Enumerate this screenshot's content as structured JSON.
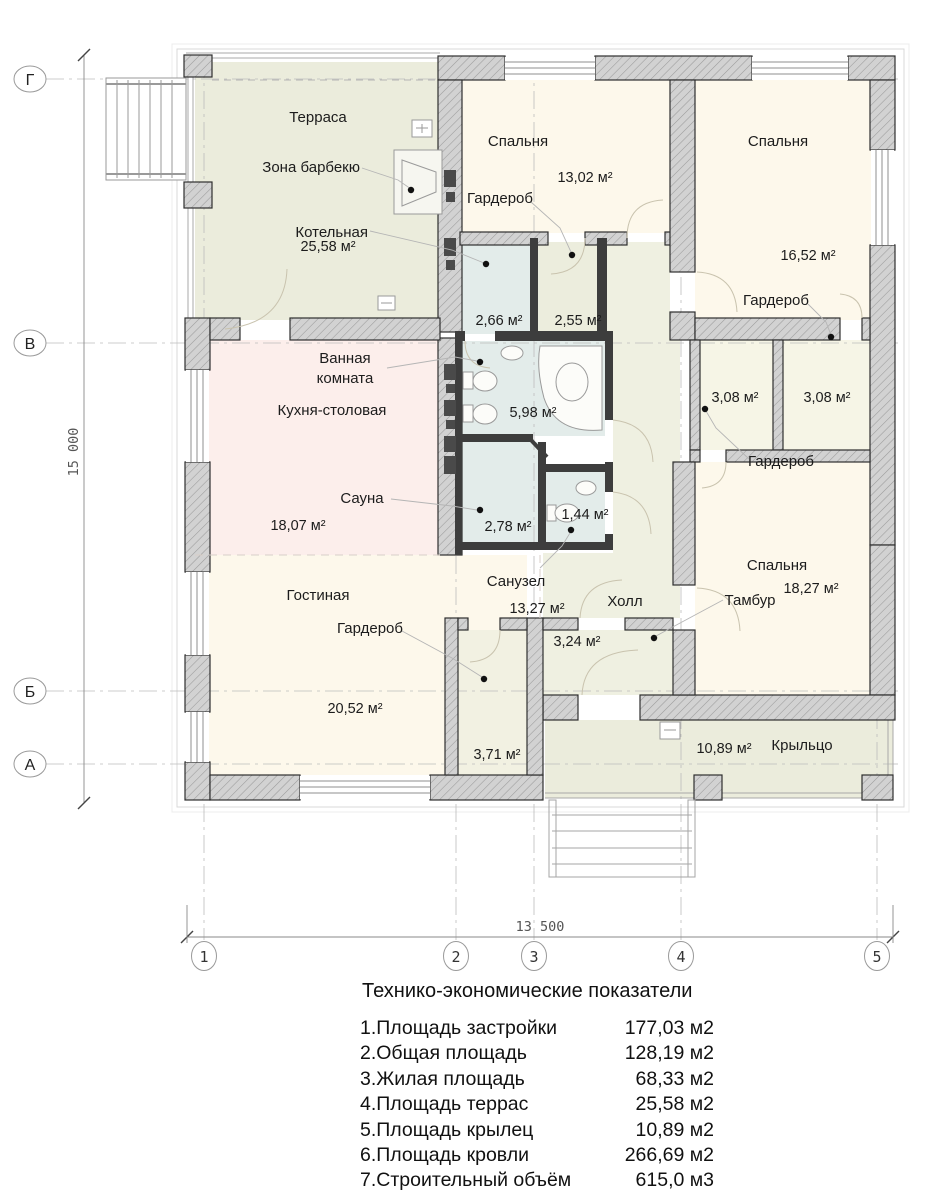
{
  "plan": {
    "rooms": {
      "terrace": {
        "name": "Терраса",
        "area": "25,58 м²"
      },
      "bbq": {
        "name": "Зона барбекю"
      },
      "boiler": {
        "name": "Котельная",
        "area": "2,66 м²"
      },
      "bedroom_tl": {
        "name": "Спальня",
        "area": "13,02 м²"
      },
      "wardrobe_tl": {
        "name": "Гардероб",
        "area": "2,55 м²"
      },
      "bedroom_tr": {
        "name": "Спальня",
        "area": "16,52 м²"
      },
      "wardrobe_r1": {
        "name": "Гардероб",
        "area": "3,08 м²"
      },
      "wardrobe_r2": {
        "name": "Гардероб",
        "area": "3,08 м²"
      },
      "bathroom": {
        "name_line1": "Ванная",
        "name_line2": "комната",
        "area": "5,98 м²"
      },
      "kitchen": {
        "name": "Кухня-столовая",
        "area": "18,07 м²"
      },
      "sauna": {
        "name": "Сауна",
        "area": "2,78 м²"
      },
      "wc": {
        "name": "Санузел",
        "area": "1,44 м²"
      },
      "living": {
        "name": "Гостиная",
        "area": "20,52 м²"
      },
      "wardrobe_lv": {
        "name": "Гардероб",
        "area": "3,71 м²"
      },
      "hall": {
        "name": "Холл",
        "area": "13,27 м²"
      },
      "tambour": {
        "name": "Тамбур",
        "area": "3,24 м²"
      },
      "bedroom_br": {
        "name": "Спальня",
        "area": "18,27 м²"
      },
      "porch": {
        "name": "Крыльцо",
        "area": "10,89 м²"
      }
    },
    "axes": {
      "rows": [
        "Г",
        "В",
        "Б",
        "А"
      ],
      "cols": [
        "1",
        "2",
        "3",
        "4",
        "5"
      ],
      "dim_vertical": "15 000",
      "dim_horizontal": "13 500"
    }
  },
  "table": {
    "title": "Технико-экономические показатели",
    "rows": [
      {
        "label": "1.Площадь застройки",
        "value": "177,03 м2"
      },
      {
        "label": "2.Общая площадь",
        "value": "128,19 м2"
      },
      {
        "label": "3.Жилая площадь",
        "value": "68,33 м2"
      },
      {
        "label": "4.Площадь террас",
        "value": "25,58 м2"
      },
      {
        "label": "5.Площадь крылец",
        "value": "10,89 м2"
      },
      {
        "label": "6.Площадь кровли",
        "value": "266,69 м2"
      },
      {
        "label": "7.Строительный объём",
        "value": "615,0 м3"
      }
    ]
  },
  "colors": {
    "wall_hatch": "#d2d2d2",
    "wall_dark": "#3d3d3d",
    "room_cream": "#fdf8eb",
    "room_green": "#ebecdc",
    "room_hall": "#eff0e1",
    "room_kitchen": "#fceeeb",
    "room_wet": "#e3ecea",
    "room_wardrobe": "#f2f1e2"
  }
}
